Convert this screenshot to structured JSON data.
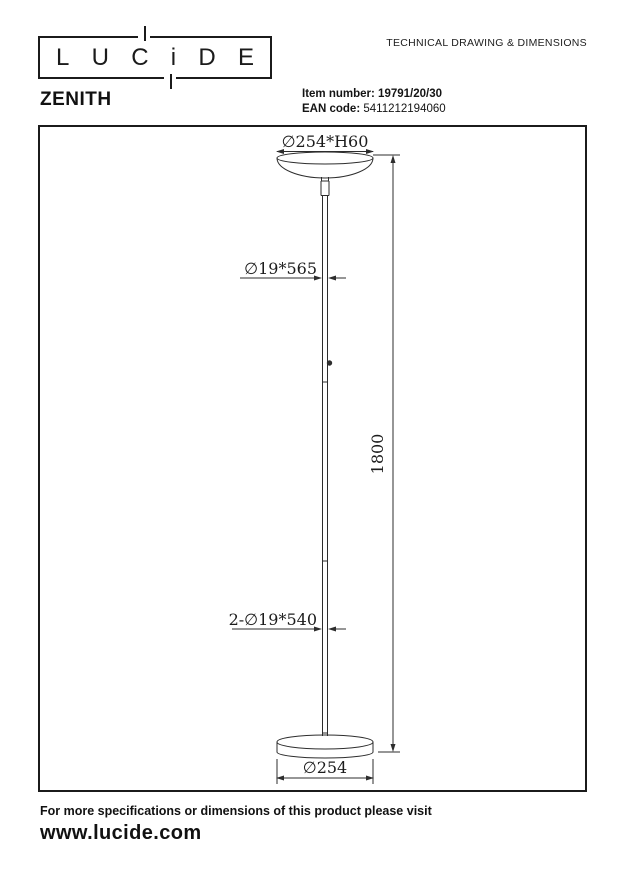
{
  "header": {
    "logo_letters": [
      "L",
      "U",
      "C",
      "i",
      "D",
      "E"
    ],
    "doc_type": "TECHNICAL DRAWING & DIMENSIONS",
    "product_name": "ZENITH",
    "item_number_label": "Item number:",
    "item_number_value": "19791/20/30",
    "ean_label": "EAN code:",
    "ean_value": "5411212194060"
  },
  "drawing": {
    "dimensions": {
      "shade": "∅254*H60",
      "upper_pole": "∅19*565",
      "total_height": "1800",
      "lower_pole": "2-∅19*540",
      "base": "∅254"
    }
  },
  "footer": {
    "note": "For more specifications or dimensions of this product please visit",
    "website": "www.lucide.com"
  },
  "colors": {
    "line": "#2d2d2d",
    "text": "#161616",
    "background": "#ffffff"
  }
}
